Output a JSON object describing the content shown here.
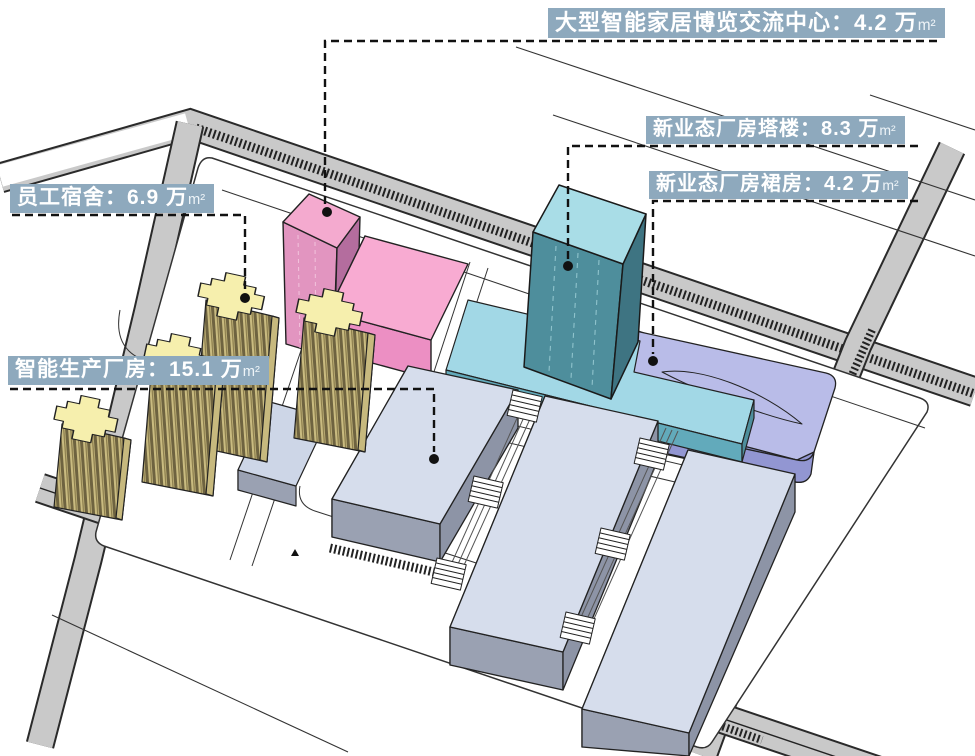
{
  "diagram": {
    "kind": "architectural-massing-site-diagram",
    "annotations": [
      {
        "id": "expo-center",
        "text": "大型智能家居博览交流中心：4.2 万",
        "unit": "m²",
        "area_wan_m2": 4.2,
        "target": "pink-expo-tower"
      },
      {
        "id": "new-industry-tower",
        "text": "新业态厂房塔楼：8.3 万",
        "unit": "m²",
        "area_wan_m2": 8.3,
        "target": "teal-tower"
      },
      {
        "id": "new-industry-podium",
        "text": "新业态厂房裙房：4.2 万",
        "unit": "m²",
        "area_wan_m2": 4.2,
        "target": "purple-podium"
      },
      {
        "id": "dormitory",
        "text": "员工宿舍：6.9 万",
        "unit": "m²",
        "area_wan_m2": 6.9,
        "target": "yellow-dorm-towers"
      },
      {
        "id": "factory",
        "text": "智能生产厂房：15.1 万",
        "unit": "m²",
        "area_wan_m2": 15.1,
        "target": "factory-halls"
      }
    ],
    "buildings": [
      {
        "name": "expo-center-tower-and-podium",
        "color_top": "#f4aacf",
        "color_front": "#e295c0"
      },
      {
        "name": "new-industry-tower",
        "color_top": "#a9dde7",
        "color_front": "#4e8e9c"
      },
      {
        "name": "new-industry-tower-base-slab",
        "color_top": "#a2d8e6"
      },
      {
        "name": "new-industry-podium",
        "color_top": "#b9bce8",
        "color_front": "#9296d2"
      },
      {
        "name": "dormitory-towers",
        "count": 4,
        "color_top": "#f6efad",
        "color_stripe_dark": "#6e6340"
      },
      {
        "name": "factory-halls",
        "count": 3,
        "color_top": "#d6ddec",
        "color_front": "#9aa1b2"
      },
      {
        "name": "small-utility-block",
        "color_top": "#cdd6e7"
      }
    ],
    "colors": {
      "annotation_bg": "#8ea9bd",
      "annotation_text": "#ffffff",
      "road": "#c9c9c9",
      "road_hatch": "#222222",
      "ground": "#ffffff",
      "outline": "#222222",
      "leader_line": "#111111",
      "leader_dot": "#111111"
    }
  }
}
